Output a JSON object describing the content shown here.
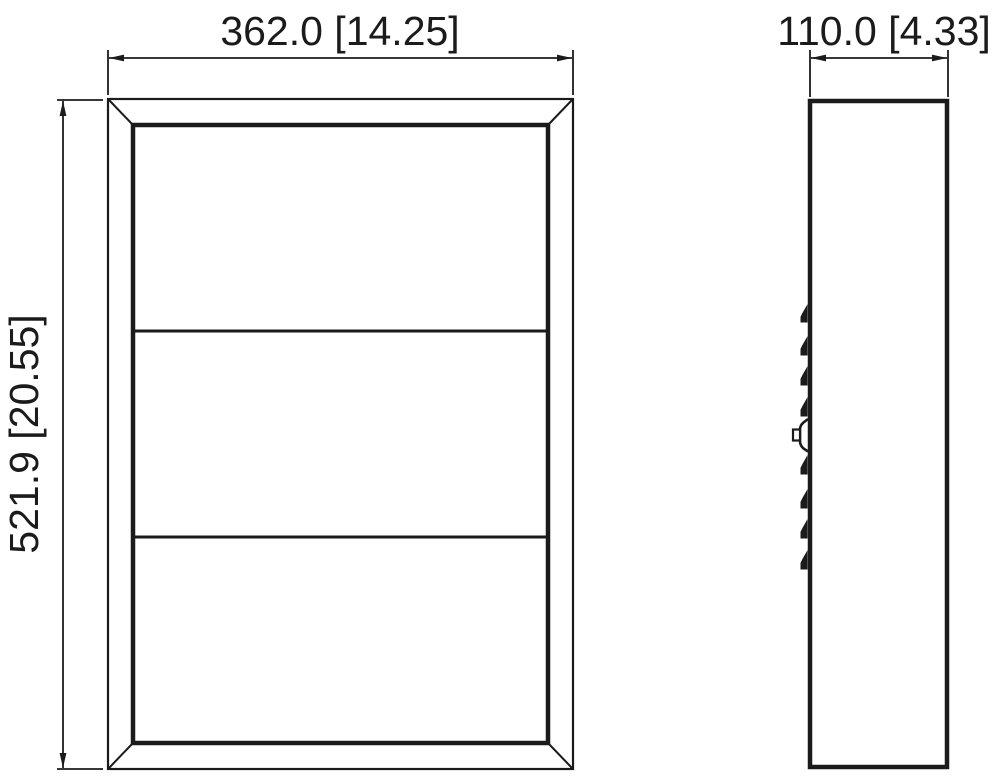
{
  "drawing": {
    "background_color": "#ffffff",
    "line_color": "#1b1b1b",
    "front_view": {
      "width_dimension": {
        "mm": "362.0",
        "inches": "14.25",
        "label": "362.0 [14.25]"
      },
      "height_dimension": {
        "mm": "521.9",
        "inches": "20.55",
        "label": "521.9 [20.55]"
      },
      "panel_count": 3
    },
    "side_view": {
      "depth_dimension": {
        "mm": "110.0",
        "inches": "4.33",
        "label": "110.0 [4.33]"
      },
      "hinge_tab_count": 8
    }
  }
}
